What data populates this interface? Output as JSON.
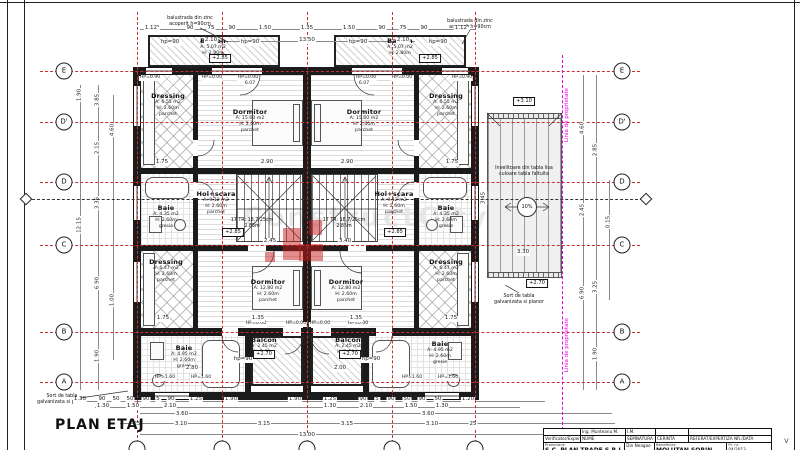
{
  "sheet": {
    "title": "PLAN ETAJ"
  },
  "watermark": {
    "text": "ConstructCity"
  },
  "grid": {
    "rows": [
      {
        "label": "E",
        "y": 71
      },
      {
        "label": "D'",
        "y": 122
      },
      {
        "label": "D",
        "y": 182
      },
      {
        "label": "C",
        "y": 245
      },
      {
        "label": "B",
        "y": 332
      },
      {
        "label": "A",
        "y": 382
      }
    ],
    "cols": [
      {
        "label": "",
        "x": 137
      },
      {
        "label": "",
        "x": 222
      },
      {
        "label": "",
        "x": 307
      },
      {
        "label": "",
        "x": 392
      },
      {
        "label": "",
        "x": 475
      }
    ]
  },
  "rooms": [
    {
      "name": "Balcon",
      "lines": [
        "A: 5.07 m2",
        "H: 2.80m"
      ],
      "x": 213,
      "y": 37
    },
    {
      "name": "Balcon",
      "lines": [
        "A: 5.07 m2",
        "H: 2.80m"
      ],
      "x": 400,
      "y": 37
    },
    {
      "name": "Dressing",
      "lines": [
        "A: 6.55 m2",
        "H: 2.60m",
        "parchet"
      ],
      "x": 168,
      "y": 92
    },
    {
      "name": "Dormitor",
      "lines": [
        "A: 15.60 m2",
        "H: 2.60m",
        "parchet"
      ],
      "x": 250,
      "y": 108
    },
    {
      "name": "Dormitor",
      "lines": [
        "A: 15.60 m2",
        "H: 2.60m",
        "parchet"
      ],
      "x": 364,
      "y": 108
    },
    {
      "name": "Dressing",
      "lines": [
        "A: 6.55 m2",
        "H: 2.60m",
        "parchet"
      ],
      "x": 446,
      "y": 92
    },
    {
      "name": "Baie",
      "lines": [
        "A: 4.35 m2",
        "H: 2.60m",
        "gresie"
      ],
      "x": 166,
      "y": 204
    },
    {
      "name": "Hol+scara",
      "lines": [
        "A: 9.12 m2",
        "H: 2.60m",
        "parchet"
      ],
      "x": 216,
      "y": 190
    },
    {
      "name": "Hol+scara",
      "lines": [
        "A: 9.12 m2",
        "H: 2.60m",
        "parchet"
      ],
      "x": 394,
      "y": 190
    },
    {
      "name": "Baie",
      "lines": [
        "A: 4.35 m2",
        "H: 2.60m",
        "gresie"
      ],
      "x": 446,
      "y": 204
    },
    {
      "name": "Dressing",
      "lines": [
        "A: 6.47 m2",
        "H: 2.60m",
        "parchet"
      ],
      "x": 166,
      "y": 258
    },
    {
      "name": "Dormitor",
      "lines": [
        "A: 12.80 m2",
        "H: 2.60m",
        "parchet"
      ],
      "x": 268,
      "y": 278
    },
    {
      "name": "Dormitor",
      "lines": [
        "A: 12.80 m2",
        "H: 2.60m",
        "parchet"
      ],
      "x": 346,
      "y": 278
    },
    {
      "name": "Dressing",
      "lines": [
        "A: 6.47 m2",
        "H: 2.60m",
        "parchet"
      ],
      "x": 446,
      "y": 258
    },
    {
      "name": "Baie",
      "lines": [
        "A: 4.95 m2",
        "H: 2.60m",
        "gresie"
      ],
      "x": 184,
      "y": 344
    },
    {
      "name": "Balcon",
      "lines": [
        "A: 2.45 m2",
        "H: 2.80m"
      ],
      "x": 264,
      "y": 336
    },
    {
      "name": "Balcon",
      "lines": [
        "A: 2.45 m2",
        "H: 2.80m"
      ],
      "x": 348,
      "y": 336
    },
    {
      "name": "Baie",
      "lines": [
        "A: 4.95 m2",
        "H: 2.60m",
        "gresie"
      ],
      "x": 440,
      "y": 340
    }
  ],
  "annotations": [
    {
      "lines": [
        "balustrada din zinc",
        "acoperit h=90cm"
      ],
      "x": 190,
      "y": 16
    },
    {
      "lines": [
        "balustrada din zinc",
        "acoperit h=90cm"
      ],
      "x": 470,
      "y": 19
    },
    {
      "lines": [
        "Invelitoare din tabla lisa",
        "culoare tabla faltuita"
      ],
      "x": 524,
      "y": 166
    },
    {
      "lines": [
        "Sort de tabla",
        "galvanizata si pianor"
      ],
      "x": 62,
      "y": 394
    },
    {
      "lines": [
        "Sort de tabla",
        "galvanizata si pianor"
      ],
      "x": 519,
      "y": 294
    },
    {
      "lines": [
        "17 TR: 18,7/25cm",
        "2.85m"
      ],
      "x": 252,
      "y": 218
    },
    {
      "lines": [
        "17 TR: 18,7/25cm",
        "2.85m"
      ],
      "x": 344,
      "y": 218
    }
  ],
  "hp_markers": [
    {
      "t": "hp=90",
      "x": 170,
      "y": 40
    },
    {
      "t": "hp=90",
      "x": 250,
      "y": 40
    },
    {
      "t": "hp=90",
      "x": 358,
      "y": 40
    },
    {
      "t": "hp=90",
      "x": 438,
      "y": 40
    },
    {
      "t": "hp=90",
      "x": 243,
      "y": 357
    },
    {
      "t": "hp=90",
      "x": 371,
      "y": 357
    }
  ],
  "small_labels": [
    {
      "t": "HP=0.90",
      "x": 150,
      "y": 76
    },
    {
      "t": "HP=0.00",
      "x": 212,
      "y": 76
    },
    {
      "t": "HP=0.00",
      "x": 248,
      "y": 76
    },
    {
      "t": "HP=0.00",
      "x": 366,
      "y": 76
    },
    {
      "t": "HP=0.00",
      "x": 402,
      "y": 76
    },
    {
      "t": "HP=0.90",
      "x": 462,
      "y": 76
    },
    {
      "t": "6.07",
      "x": 250,
      "y": 82
    },
    {
      "t": "6.07",
      "x": 364,
      "y": 82
    },
    {
      "t": "HP=0.00",
      "x": 256,
      "y": 322
    },
    {
      "t": "HP=0.00",
      "x": 296,
      "y": 322
    },
    {
      "t": "HP=0.00",
      "x": 320,
      "y": 322
    },
    {
      "t": "HP=0.00",
      "x": 358,
      "y": 322
    },
    {
      "t": "HP=1.60",
      "x": 165,
      "y": 376
    },
    {
      "t": "HP=1.60",
      "x": 201,
      "y": 376
    },
    {
      "t": "HP=1.60",
      "x": 412,
      "y": 376
    },
    {
      "t": "HP=1.60",
      "x": 448,
      "y": 376
    }
  ],
  "level_markers": [
    {
      "t": "+2.85",
      "x": 220,
      "y": 54
    },
    {
      "t": "+2.85",
      "x": 430,
      "y": 54
    },
    {
      "t": "+2.85",
      "x": 233,
      "y": 228
    },
    {
      "t": "+2.85",
      "x": 395,
      "y": 228
    },
    {
      "t": "+2.70",
      "x": 264,
      "y": 350
    },
    {
      "t": "+2.70",
      "x": 350,
      "y": 350
    },
    {
      "t": "+3.10",
      "x": 524,
      "y": 97
    },
    {
      "t": "+2.70",
      "x": 537,
      "y": 279
    }
  ],
  "dims_h": [
    {
      "t": "1.12⁵",
      "x": 152,
      "y": 26
    },
    {
      "t": "90",
      "x": 190,
      "y": 26
    },
    {
      "t": "75",
      "x": 211,
      "y": 26
    },
    {
      "t": "90",
      "x": 232,
      "y": 26
    },
    {
      "t": "1.50",
      "x": 265,
      "y": 26
    },
    {
      "t": "1.35",
      "x": 307,
      "y": 26
    },
    {
      "t": "1.50",
      "x": 349,
      "y": 26
    },
    {
      "t": "90",
      "x": 382,
      "y": 26
    },
    {
      "t": "75",
      "x": 403,
      "y": 26
    },
    {
      "t": "90",
      "x": 424,
      "y": 26
    },
    {
      "t": "1.12⁵",
      "x": 462,
      "y": 26
    },
    {
      "t": "2.10",
      "x": 211,
      "y": 38
    },
    {
      "t": "13.50",
      "x": 307,
      "y": 38
    },
    {
      "t": "2.10",
      "x": 403,
      "y": 38
    },
    {
      "t": "1.75",
      "x": 162,
      "y": 160
    },
    {
      "t": "2.90",
      "x": 267,
      "y": 160
    },
    {
      "t": "2.90",
      "x": 347,
      "y": 160
    },
    {
      "t": "1.75",
      "x": 452,
      "y": 160
    },
    {
      "t": "2.45",
      "x": 270,
      "y": 239
    },
    {
      "t": "3.40",
      "x": 345,
      "y": 239
    },
    {
      "t": "1.75",
      "x": 163,
      "y": 316
    },
    {
      "t": "1.35",
      "x": 258,
      "y": 316
    },
    {
      "t": "1.35",
      "x": 356,
      "y": 316
    },
    {
      "t": "1.75",
      "x": 451,
      "y": 316
    },
    {
      "t": "2.80",
      "x": 192,
      "y": 366
    },
    {
      "t": "2.00",
      "x": 340,
      "y": 366
    },
    {
      "t": "3.30",
      "x": 523,
      "y": 250
    },
    {
      "t": "1.30",
      "x": 80,
      "y": 397
    },
    {
      "t": "90",
      "x": 102,
      "y": 397
    },
    {
      "t": "50",
      "x": 116,
      "y": 397
    },
    {
      "t": "50",
      "x": 130,
      "y": 397
    },
    {
      "t": "90",
      "x": 146,
      "y": 397
    },
    {
      "t": "5",
      "x": 158,
      "y": 397
    },
    {
      "t": "90",
      "x": 171,
      "y": 397
    },
    {
      "t": "1.25",
      "x": 196,
      "y": 397
    },
    {
      "t": "1.90",
      "x": 231,
      "y": 397
    },
    {
      "t": "1.90",
      "x": 295,
      "y": 397
    },
    {
      "t": "1.25",
      "x": 330,
      "y": 397
    },
    {
      "t": "90",
      "x": 363,
      "y": 397
    },
    {
      "t": "5",
      "x": 377,
      "y": 397
    },
    {
      "t": "90",
      "x": 391,
      "y": 397
    },
    {
      "t": "50",
      "x": 407,
      "y": 397
    },
    {
      "t": "90",
      "x": 422,
      "y": 397
    },
    {
      "t": "50",
      "x": 438,
      "y": 397
    },
    {
      "t": "1.20",
      "x": 468,
      "y": 397
    },
    {
      "t": "1.30",
      "x": 103,
      "y": 404
    },
    {
      "t": "1.50",
      "x": 133,
      "y": 404
    },
    {
      "t": "2.10",
      "x": 170,
      "y": 404
    },
    {
      "t": "1.30",
      "x": 330,
      "y": 404
    },
    {
      "t": "2.10",
      "x": 366,
      "y": 404
    },
    {
      "t": "1.50",
      "x": 411,
      "y": 404
    },
    {
      "t": "1.30",
      "x": 442,
      "y": 404
    },
    {
      "t": "3.60",
      "x": 182,
      "y": 412
    },
    {
      "t": "3.60",
      "x": 428,
      "y": 412
    },
    {
      "t": "25",
      "x": 137,
      "y": 422
    },
    {
      "t": "3.10",
      "x": 181,
      "y": 422
    },
    {
      "t": "3.15",
      "x": 264,
      "y": 422
    },
    {
      "t": "3.15",
      "x": 347,
      "y": 422
    },
    {
      "t": "3.10",
      "x": 432,
      "y": 422
    },
    {
      "t": "25",
      "x": 473,
      "y": 422
    },
    {
      "t": "13.00",
      "x": 307,
      "y": 433
    }
  ],
  "dims_v": [
    {
      "t": "1.90",
      "x": 80,
      "y": 95
    },
    {
      "t": "12.15",
      "x": 80,
      "y": 225
    },
    {
      "t": "3.85",
      "x": 98,
      "y": 100
    },
    {
      "t": "2.15",
      "x": 98,
      "y": 148
    },
    {
      "t": "3.35",
      "x": 98,
      "y": 203
    },
    {
      "t": "6.90",
      "x": 98,
      "y": 283
    },
    {
      "t": "1.90",
      "x": 98,
      "y": 356
    },
    {
      "t": "4.60",
      "x": 113,
      "y": 130
    },
    {
      "t": "1.00",
      "x": 113,
      "y": 300
    },
    {
      "t": "4.60",
      "x": 583,
      "y": 128
    },
    {
      "t": "2.45",
      "x": 583,
      "y": 210
    },
    {
      "t": "6.90",
      "x": 583,
      "y": 293
    },
    {
      "t": "2.85",
      "x": 596,
      "y": 150
    },
    {
      "t": "3.25",
      "x": 596,
      "y": 287
    },
    {
      "t": "1.90",
      "x": 596,
      "y": 354
    },
    {
      "t": "0.15",
      "x": 609,
      "y": 222
    },
    {
      "t": "3.45",
      "x": 484,
      "y": 198
    }
  ],
  "property_line": {
    "label": "Linia de proprietate",
    "color": "#e800e8"
  },
  "slope": {
    "t": "10%"
  },
  "title_block": {
    "r1": [
      "",
      "Ing. Munteanu M.",
      "I.M.",
      "",
      ""
    ],
    "r2": [
      "Verificator/Expert",
      "NUME",
      "SEMNATURA",
      "CERINTA",
      "REFERAT/EXPERTIZA NR./DATA"
    ],
    "proiectant_label": "Proiectant:",
    "proiectant": "S.C. PLAN TRADE S.R.L.",
    "mid": "Din Neagoe",
    "beneficiar_label": "Beneficiar:",
    "beneficiar": "MOLUTAN SORIN",
    "pr_label": "Pr. nr.",
    "pr_nr": "04/2013"
  },
  "misc": {
    "fold_mark": "v"
  }
}
